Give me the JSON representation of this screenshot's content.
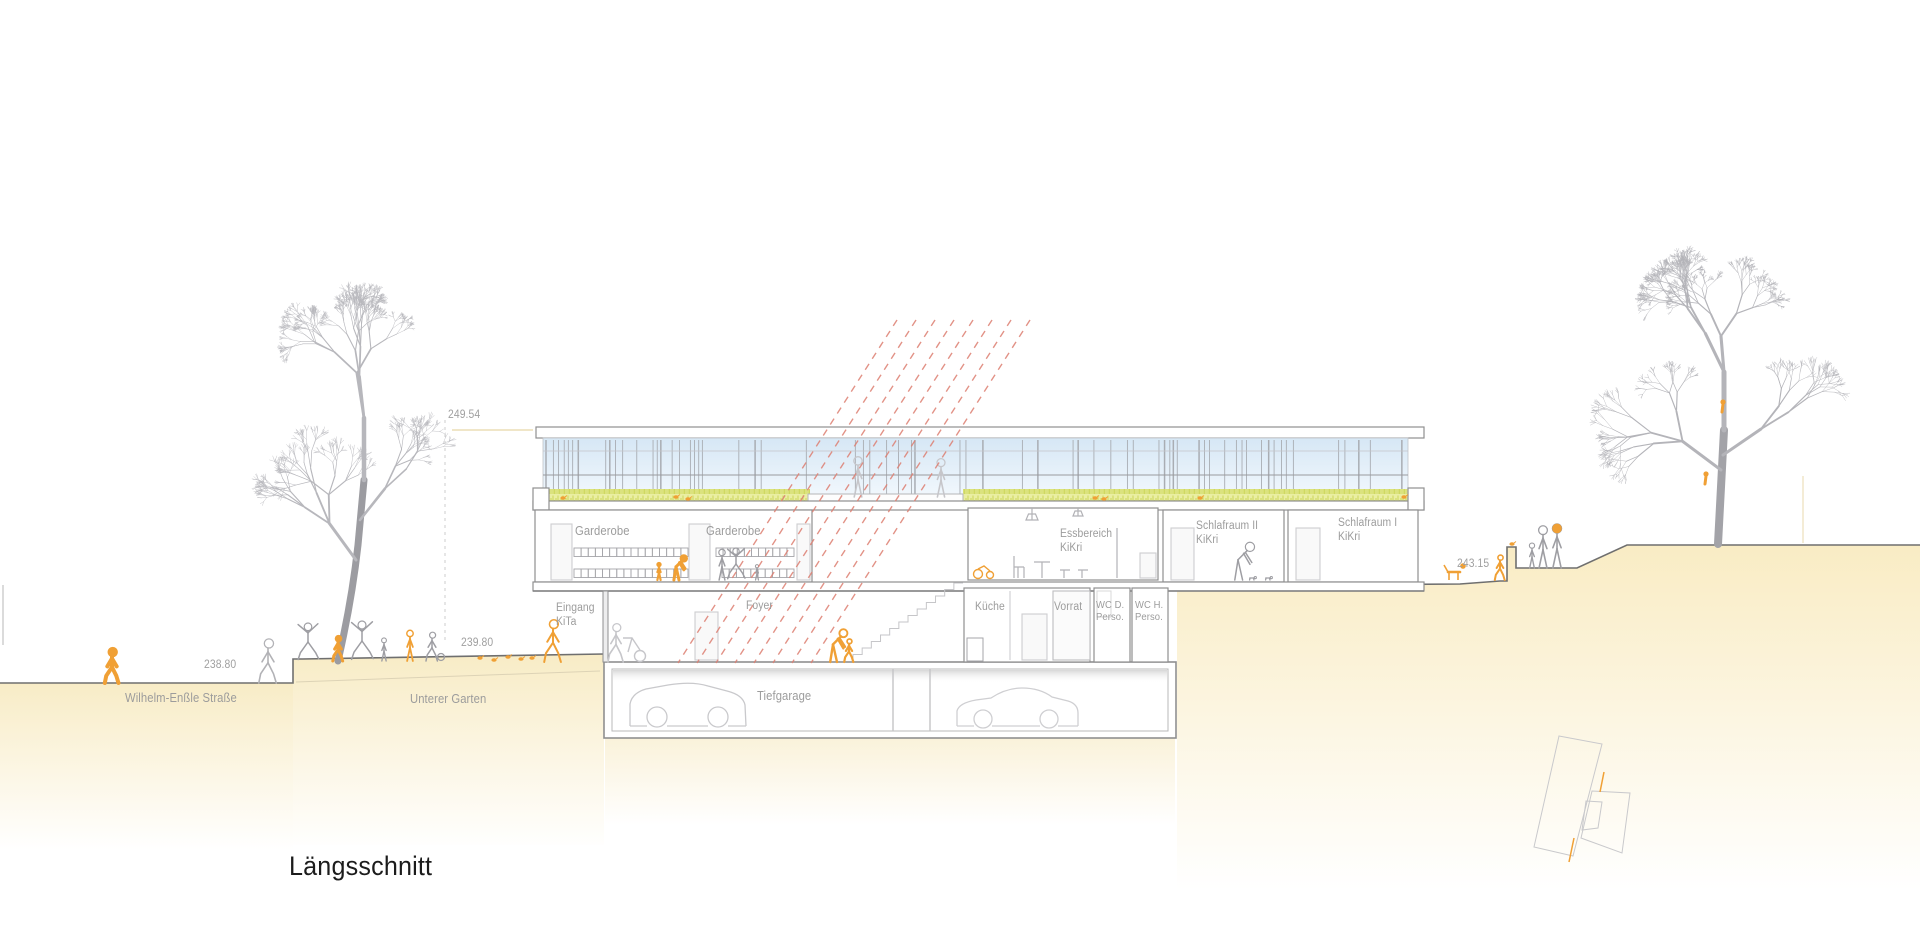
{
  "drawing": {
    "title": "Längsschnitt"
  },
  "levels": {
    "roof": "249.54",
    "upper_garden": "239.80",
    "street": "238.80",
    "rear_garden": "243.15"
  },
  "rooms": {
    "garderobe_left": "Garderobe",
    "garderobe_right": "Garderobe",
    "essbereich": "Essbereich\nKiKri",
    "schlafraum_2": "Schlafraum II\nKiKri",
    "schlafraum_1": "Schlafraum I\nKiKri",
    "eingang": "Eingang\nKiTa",
    "foyer": "Foyer",
    "kueche": "Küche",
    "vorrat": "Vorrat",
    "wc_d": "WC D.\nPerso.",
    "wc_h": "WC H.\nPerso.",
    "tiefgarage": "Tiefgarage"
  },
  "site": {
    "street_name": "Wilhelm-Enßle Straße",
    "garden_name": "Unterer Garten"
  },
  "colors": {
    "accent_orange": "#f0a035",
    "sun_ray_red": "#dd7f72",
    "terrain_beige": "#f8ecc6",
    "grass_green": "#dce269",
    "sky_blue": "#d8e8f6",
    "label_gray": "#9c9c9c",
    "line_gray": "#8f8f8f"
  }
}
